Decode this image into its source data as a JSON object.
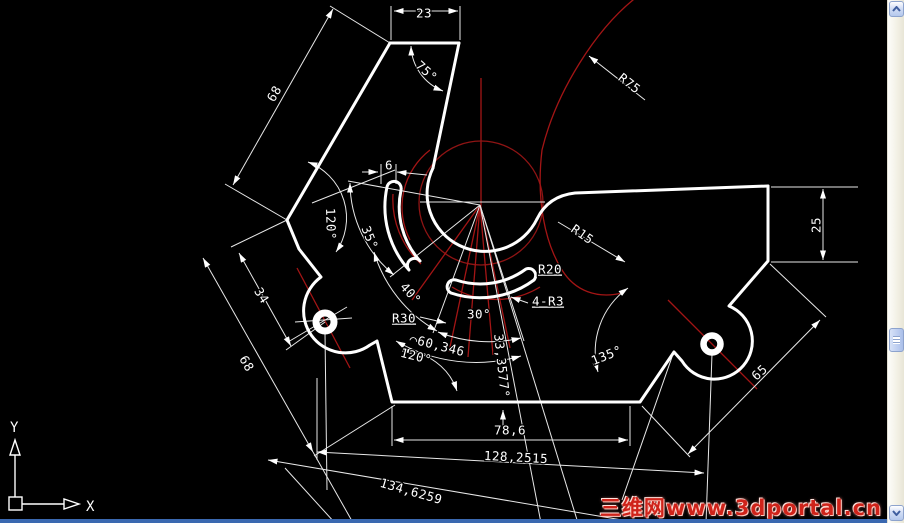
{
  "canvas": {
    "width": 904,
    "height": 523,
    "background": "#000000"
  },
  "colors": {
    "outline": "#ffffff",
    "construction_red": "#a31515",
    "dim_line": "#e8e8e8",
    "watermark_red": "#cf231a",
    "scroll_accent": "#3a68b0"
  },
  "ucs": {
    "x_label": "X",
    "y_label": "Y"
  },
  "watermark": {
    "text": "三维网www.3dportal.cn"
  },
  "scrollbar": {
    "up_icon": "chevron-up",
    "down_icon": "chevron-down",
    "thumb": "drag-thumb"
  },
  "dimensions": [
    {
      "text": "23",
      "x": 424,
      "y": 14,
      "rot": 0,
      "underline": false
    },
    {
      "text": "75°",
      "x": 426,
      "y": 72,
      "rot": 42,
      "underline": false
    },
    {
      "text": "68",
      "x": 275,
      "y": 94,
      "rot": -60,
      "underline": false
    },
    {
      "text": "R75",
      "x": 629,
      "y": 84,
      "rot": 38,
      "underline": false
    },
    {
      "text": "6",
      "x": 389,
      "y": 166,
      "rot": 0,
      "underline": false
    },
    {
      "text": "120°",
      "x": 330,
      "y": 224,
      "rot": 88,
      "underline": false
    },
    {
      "text": "35°",
      "x": 369,
      "y": 238,
      "rot": 68,
      "underline": false
    },
    {
      "text": "40°",
      "x": 410,
      "y": 294,
      "rot": 48,
      "underline": false
    },
    {
      "text": "R30",
      "x": 404,
      "y": 319,
      "rot": 0,
      "underline": true
    },
    {
      "text": "30°",
      "x": 479,
      "y": 315,
      "rot": 0,
      "underline": false
    },
    {
      "text": "R20",
      "x": 550,
      "y": 270,
      "rot": 0,
      "underline": true
    },
    {
      "text": "4-R3",
      "x": 548,
      "y": 302,
      "rot": 0,
      "underline": true
    },
    {
      "text": "R15",
      "x": 582,
      "y": 235,
      "rot": 35,
      "underline": false
    },
    {
      "text": "⌒60,346",
      "x": 437,
      "y": 346,
      "rot": 14,
      "underline": false
    },
    {
      "text": "120°",
      "x": 416,
      "y": 357,
      "rot": 14,
      "underline": false
    },
    {
      "text": "33,3577°",
      "x": 501,
      "y": 366,
      "rot": 84,
      "underline": false
    },
    {
      "text": "135°",
      "x": 607,
      "y": 356,
      "rot": -22,
      "underline": false
    },
    {
      "text": "78,6",
      "x": 510,
      "y": 431,
      "rot": 0,
      "underline": false
    },
    {
      "text": "128,2515",
      "x": 516,
      "y": 458,
      "rot": 3,
      "underline": false
    },
    {
      "text": "134,6259",
      "x": 411,
      "y": 492,
      "rot": 16,
      "underline": false
    },
    {
      "text": "34",
      "x": 261,
      "y": 296,
      "rot": 58,
      "underline": false
    },
    {
      "text": "68",
      "x": 246,
      "y": 364,
      "rot": 60,
      "underline": false
    },
    {
      "text": "25",
      "x": 817,
      "y": 225,
      "rot": -90,
      "underline": false
    },
    {
      "text": "65",
      "x": 760,
      "y": 373,
      "rot": -42,
      "underline": false
    }
  ]
}
